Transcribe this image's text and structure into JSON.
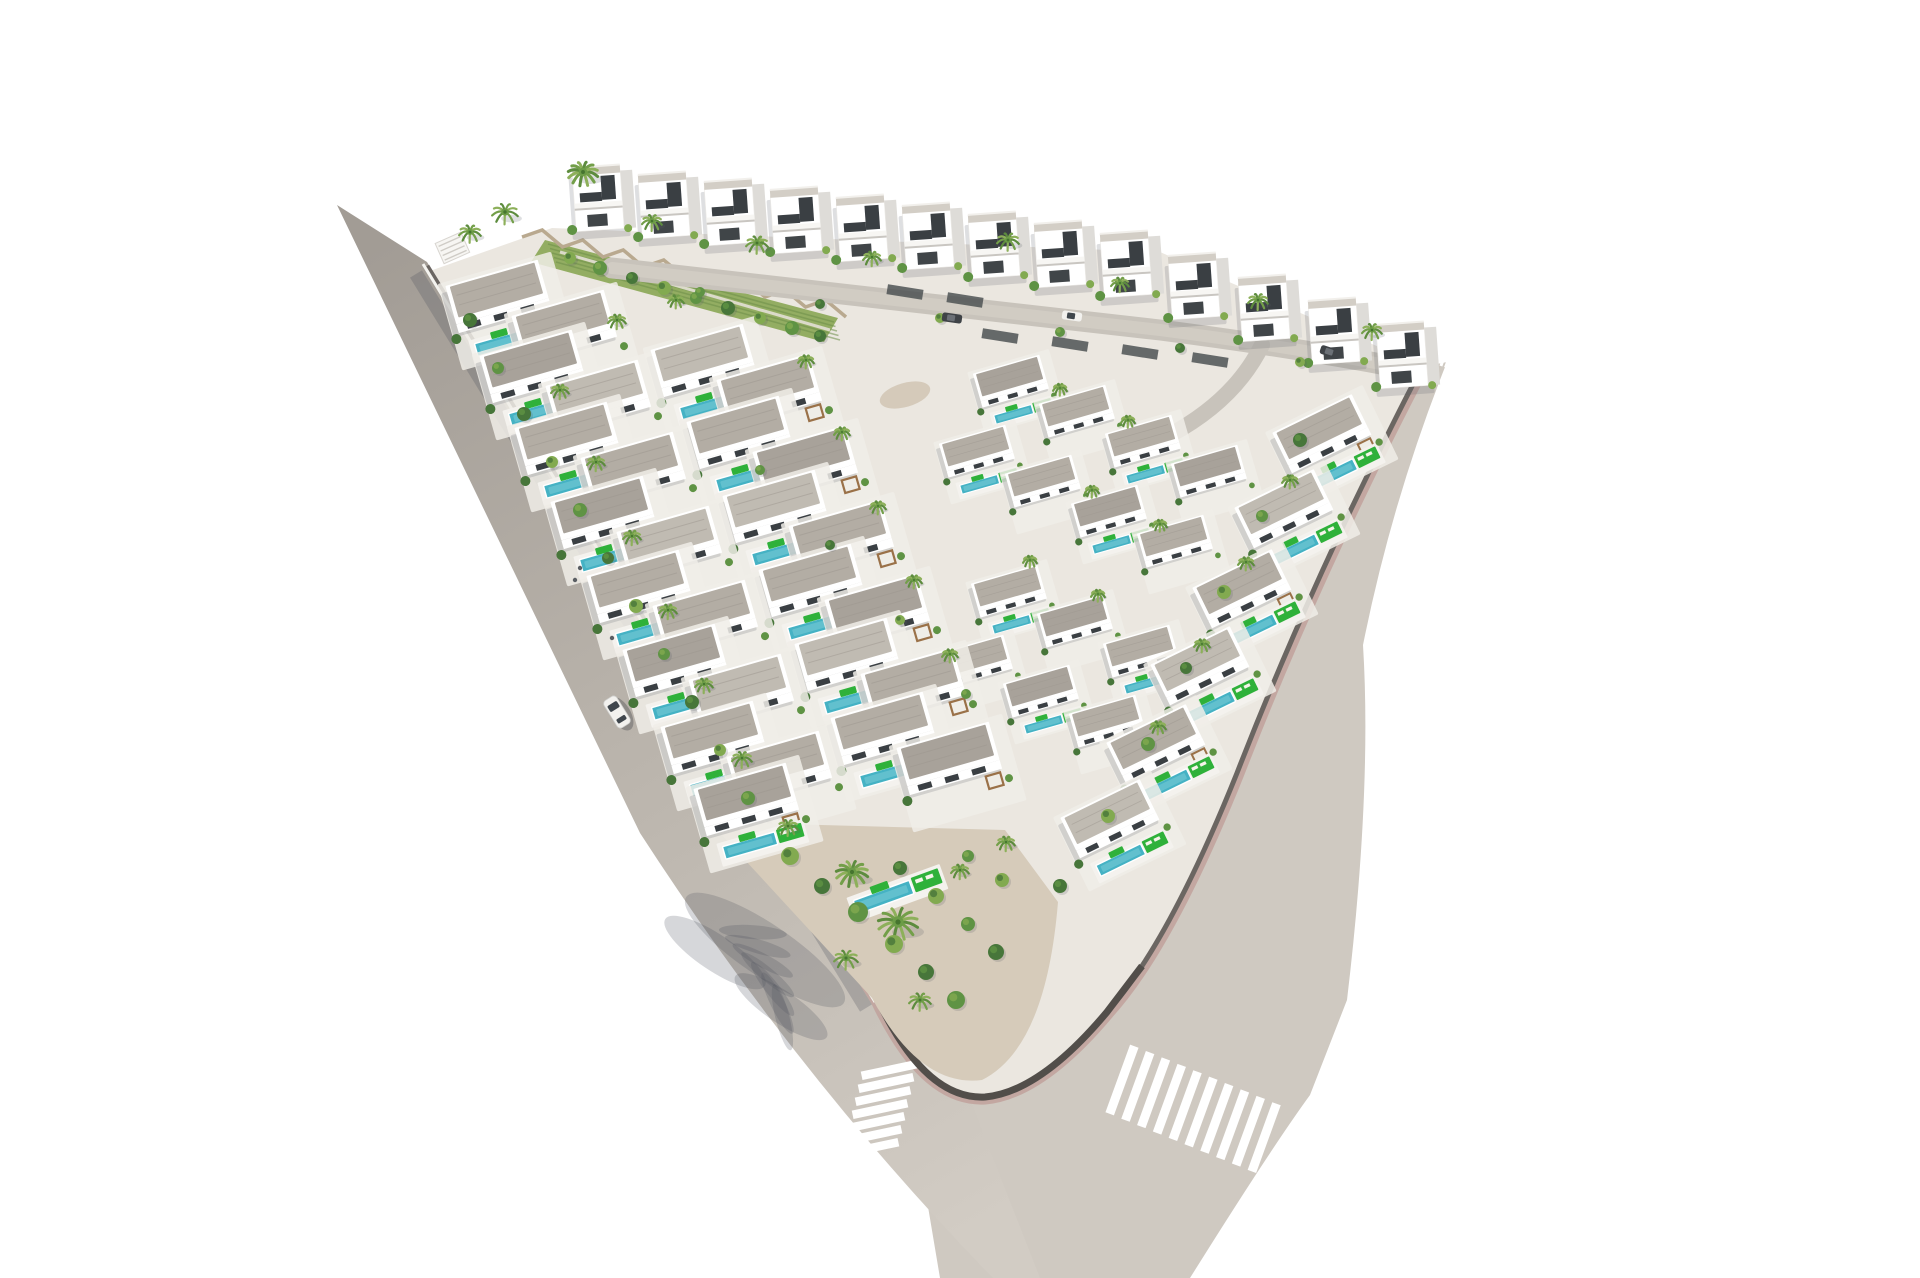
{
  "meta": {
    "description": "Aerial 3D render of a triangular villa development with pools and palm trees, bordered by two roads meeting at a V-junction with zebra crossings",
    "width": 1920,
    "height": 1278
  },
  "palette": {
    "bg": "#ffffff",
    "road_top": "#a29c95",
    "road_mid": "#b8b2aa",
    "road_light": "#d2ccc4",
    "road_right": "#cfc9c1",
    "street": "#c8c3bb",
    "street_core": "#d3cec6",
    "plot": "#ebe7e0",
    "terrace": "#f0ede7",
    "brick": "#c2a59f",
    "wall": "#6b6662",
    "wall_dark": "#524e4a",
    "curb_white": "#f4f3ef",
    "villa_white": "#ffffff",
    "villa_side": "#dedcd8",
    "roof": "#b3ada4",
    "roof_dark": "#a8a29a",
    "roof_light": "#c0bbb2",
    "roof_cap": "#d3cec6",
    "window_dark": "#3a3f43",
    "pool": "#45b2c4",
    "pool_hi": "#7accd7",
    "lawn": "#2fb13a",
    "wood": "#9a7148",
    "sand": "#d6cbba",
    "gravel_bed": "#cfc3b0",
    "zigzag": "#b9a98f",
    "palm_tones": [
      "#5d8c3e",
      "#739f49",
      "#8db05a"
    ],
    "palm_center": "#6c9c47",
    "palm_dark": "#46752f",
    "trunk": "#a18762",
    "shrub_tones": [
      "#47763a",
      "#5f9344",
      "#82aa50"
    ],
    "shadow": "rgba(90,95,105,0.20)",
    "road_shadow": "rgba(70,75,88,0.25)",
    "stripe": "#ffffff",
    "car_dark": "#3f4347",
    "car_white": "#f2f1ee",
    "garden_green": "#93ad62",
    "garden_row": "#6d8f4a"
  },
  "geometry": {
    "left_road": "M 337,205 L 427,262 L 878,1000 Q 912,1078 968,1094 L 1040,1278 L 993,1278 Q 800,1080 640,833 Z",
    "right_road": "M 1447,362 L 1422,367 Q 1316,570 1237,773 Q 1168,945 1107,1012 Q 1040,1092 985,1097 L 900,1040 L 940,1278 L 1190,1278 Q 1270,1150 1310,1095 L 1347,1000 Q 1372,790 1363,645 Q 1392,500 1447,362 Z",
    "plot": "M 427,272 L 552,228 L 1160,252 L 1425,367 Q 1316,570 1237,773 Q 1168,945 1107,1012 Q 1040,1092 985,1097 Q 925,1100 878,1000 Z",
    "wall_inner": "M 427,266 L 878,1000 Q 925,1100 985,1097 Q 1040,1092 1107,1012 Q 1168,945 1237,773 Q 1316,570 1422,367",
    "brick_band": "M 1422,367 Q 1316,570 1237,773 Q 1168,945 1107,1012 Q 1040,1092 985,1097 Q 925,1100 878,1000 L 600,548",
    "tip_wall": "M 812,895 L 878,1000 Q 925,1100 985,1097 Q 1040,1092 1107,1012 L 1142,966",
    "curb_line": [
      [
        423,
        264
      ],
      [
        875,
        1002
      ]
    ],
    "wall_road_shadow": [
      [
        416,
        274
      ],
      [
        866,
        1008
      ]
    ],
    "tip_garden": "M 710,822 L 1005,830 L 1058,902 Q 1046,1048 982,1080 Q 920,1088 872,998 L 745,860 Z",
    "garden_strip": "M 545,240 L 838,318 L 824,342 L 531,262 Z",
    "garden_path": [
      [
        560,
        252
      ],
      [
        830,
        330
      ]
    ],
    "street": "M 612,268 Q 900,300 1160,330 Q 1300,348 1418,371",
    "street_branch": "M 1262,345 Q 1235,400 1170,435"
  },
  "zigzag_wall": {
    "x1": 522,
    "y1": 231,
    "x2": 846,
    "y2": 311,
    "teeth": 16,
    "amp": 6
  },
  "stairs": {
    "x": 452,
    "y": 247,
    "rot": -24,
    "steps": 4
  },
  "crosswalks": {
    "left": {
      "cx": 889,
      "cy": 1070,
      "dx": -3.0,
      "dy": 13.0,
      "n": 7,
      "w": 56,
      "h": 8.5,
      "rot": -12
    },
    "right": {
      "cx": 1122,
      "cy": 1080,
      "dx": 15.8,
      "dy": 6.4,
      "n": 10,
      "w": 9,
      "h": 72,
      "rot": 20
    },
    "entrance": {
      "cx": 1429,
      "cy": 356,
      "dx": 4.6,
      "dy": 1.6,
      "n": 5,
      "w": 3,
      "h": 11,
      "rot": 20
    }
  },
  "villas": {
    "back_row": [
      [
        600,
        198
      ],
      [
        666,
        205
      ],
      [
        732,
        212
      ],
      [
        798,
        220
      ],
      [
        864,
        228
      ],
      [
        930,
        236
      ],
      [
        996,
        245
      ],
      [
        1062,
        254
      ],
      [
        1128,
        264
      ],
      [
        1196,
        286
      ],
      [
        1266,
        308
      ],
      [
        1336,
        331
      ],
      [
        1404,
        355
      ]
    ],
    "left_pairs": [
      [
        497,
        292
      ],
      [
        531,
        362
      ],
      [
        566,
        434
      ],
      [
        602,
        508
      ],
      [
        638,
        582
      ],
      [
        674,
        656
      ],
      [
        712,
        733
      ],
      [
        745,
        795
      ]
    ],
    "left_single_last": true,
    "middle_pairs": [
      [
        702,
        356
      ],
      [
        738,
        428
      ],
      [
        774,
        502
      ],
      [
        810,
        576
      ],
      [
        846,
        650
      ],
      [
        882,
        724
      ]
    ],
    "pair_offset": [
      66,
      30
    ],
    "right_units": [
      [
        1010,
        378
      ],
      [
        1076,
        408
      ],
      [
        1142,
        438
      ],
      [
        1208,
        468
      ],
      [
        976,
        448
      ],
      [
        1042,
        478
      ],
      [
        1108,
        508
      ],
      [
        1174,
        538
      ],
      [
        1008,
        588
      ],
      [
        1074,
        618
      ],
      [
        1140,
        648
      ],
      [
        974,
        658
      ],
      [
        1040,
        688
      ],
      [
        1106,
        718
      ]
    ],
    "edge_units": [
      [
        1320,
        430
      ],
      [
        1282,
        505
      ],
      [
        1240,
        585
      ],
      [
        1198,
        662
      ],
      [
        1154,
        740
      ],
      [
        1108,
        815
      ]
    ],
    "inner_rot": -16,
    "edge_rot": -26,
    "right_scale": 0.72,
    "edge_scale": 0.92
  },
  "street_walls": [
    [
      1000,
      336
    ],
    [
      1070,
      344
    ],
    [
      1140,
      352
    ],
    [
      1210,
      360
    ],
    [
      905,
      292
    ],
    [
      965,
      300
    ]
  ],
  "tip_garden_pool": {
    "x": 895,
    "y": 893,
    "rot": -20
  },
  "vegetation": {
    "palms": [
      [
        470,
        232,
        11
      ],
      [
        505,
        212,
        13
      ],
      [
        583,
        172,
        15
      ],
      [
        652,
        221,
        10
      ],
      [
        757,
        243,
        11
      ],
      [
        872,
        257,
        9
      ],
      [
        1008,
        240,
        11
      ],
      [
        1120,
        283,
        9
      ],
      [
        1258,
        300,
        10
      ],
      [
        1372,
        330,
        10
      ],
      [
        617,
        320,
        9
      ],
      [
        676,
        300,
        8
      ],
      [
        560,
        390,
        9
      ],
      [
        596,
        462,
        9
      ],
      [
        632,
        536,
        9
      ],
      [
        668,
        610,
        9
      ],
      [
        704,
        684,
        9
      ],
      [
        742,
        758,
        10
      ],
      [
        806,
        360,
        8
      ],
      [
        842,
        432,
        8
      ],
      [
        878,
        506,
        8
      ],
      [
        914,
        580,
        8
      ],
      [
        950,
        654,
        8
      ],
      [
        1060,
        388,
        7
      ],
      [
        1128,
        420,
        7
      ],
      [
        1092,
        490,
        7
      ],
      [
        1160,
        524,
        7
      ],
      [
        1030,
        560,
        7
      ],
      [
        1098,
        594,
        7
      ],
      [
        1290,
        480,
        8
      ],
      [
        1246,
        562,
        8
      ],
      [
        1202,
        644,
        8
      ],
      [
        1158,
        726,
        8
      ],
      [
        788,
        826,
        10
      ],
      [
        852,
        872,
        16
      ],
      [
        898,
        922,
        20
      ],
      [
        846,
        958,
        12
      ],
      [
        920,
        1000,
        11
      ],
      [
        960,
        870,
        9
      ],
      [
        1006,
        842,
        9
      ]
    ],
    "shrubs": [
      [
        470,
        320,
        7,
        0
      ],
      [
        498,
        368,
        6,
        1
      ],
      [
        524,
        414,
        7,
        0
      ],
      [
        552,
        462,
        6,
        2
      ],
      [
        580,
        510,
        7,
        1
      ],
      [
        608,
        558,
        6,
        0
      ],
      [
        636,
        606,
        7,
        2
      ],
      [
        664,
        654,
        6,
        1
      ],
      [
        692,
        702,
        7,
        0
      ],
      [
        720,
        750,
        6,
        2
      ],
      [
        748,
        798,
        7,
        1
      ],
      [
        570,
        258,
        6,
        2
      ],
      [
        600,
        268,
        7,
        1
      ],
      [
        632,
        278,
        6,
        0
      ],
      [
        664,
        288,
        7,
        2
      ],
      [
        696,
        298,
        6,
        1
      ],
      [
        728,
        308,
        7,
        0
      ],
      [
        760,
        318,
        6,
        2
      ],
      [
        792,
        328,
        7,
        1
      ],
      [
        820,
        336,
        6,
        0
      ],
      [
        790,
        856,
        9,
        2
      ],
      [
        822,
        886,
        8,
        0
      ],
      [
        858,
        912,
        10,
        1
      ],
      [
        894,
        944,
        9,
        2
      ],
      [
        926,
        972,
        8,
        0
      ],
      [
        956,
        1000,
        9,
        1
      ],
      [
        900,
        868,
        7,
        0
      ],
      [
        936,
        896,
        8,
        2
      ],
      [
        968,
        924,
        7,
        1
      ],
      [
        996,
        952,
        8,
        0
      ],
      [
        1002,
        880,
        7,
        2
      ],
      [
        968,
        856,
        6,
        1
      ],
      [
        1300,
        440,
        7,
        0
      ],
      [
        1262,
        516,
        6,
        1
      ],
      [
        1224,
        592,
        7,
        2
      ],
      [
        1186,
        668,
        6,
        0
      ],
      [
        1148,
        744,
        7,
        1
      ],
      [
        1108,
        816,
        7,
        2
      ],
      [
        1060,
        886,
        7,
        0
      ],
      [
        700,
        292,
        5,
        1
      ],
      [
        820,
        304,
        5,
        0
      ],
      [
        940,
        318,
        5,
        2
      ],
      [
        1060,
        332,
        5,
        1
      ],
      [
        1180,
        348,
        5,
        0
      ],
      [
        1300,
        362,
        5,
        2
      ],
      [
        760,
        470,
        5,
        1
      ],
      [
        830,
        545,
        5,
        0
      ],
      [
        900,
        620,
        5,
        2
      ],
      [
        966,
        694,
        5,
        1
      ]
    ],
    "gravel_patches": [
      [
        655,
        640,
        30,
        14
      ],
      [
        620,
        566,
        28,
        12
      ],
      [
        690,
        714,
        30,
        14
      ],
      [
        585,
        492,
        26,
        12
      ],
      [
        550,
        418,
        24,
        11
      ],
      [
        515,
        344,
        22,
        10
      ],
      [
        760,
        788,
        30,
        14
      ],
      [
        905,
        395,
        26,
        12
      ],
      [
        970,
        460,
        26,
        12
      ]
    ]
  },
  "palm_road_shadow": {
    "x": 765,
    "y": 950,
    "rot": 34
  },
  "vehicles": [
    {
      "kind": "car_moving",
      "x": 617,
      "y": 712,
      "rot": -32,
      "color": "white"
    },
    {
      "kind": "car_parked",
      "x": 952,
      "y": 318,
      "rot": 8,
      "color": "dark"
    },
    {
      "kind": "car_parked",
      "x": 1072,
      "y": 316,
      "rot": 8,
      "color": "white"
    },
    {
      "kind": "car_parked",
      "x": 1330,
      "y": 352,
      "rot": 18,
      "color": "dark"
    }
  ],
  "figures": [
    [
      575,
      580
    ],
    [
      612,
      638
    ],
    [
      580,
      568
    ]
  ]
}
